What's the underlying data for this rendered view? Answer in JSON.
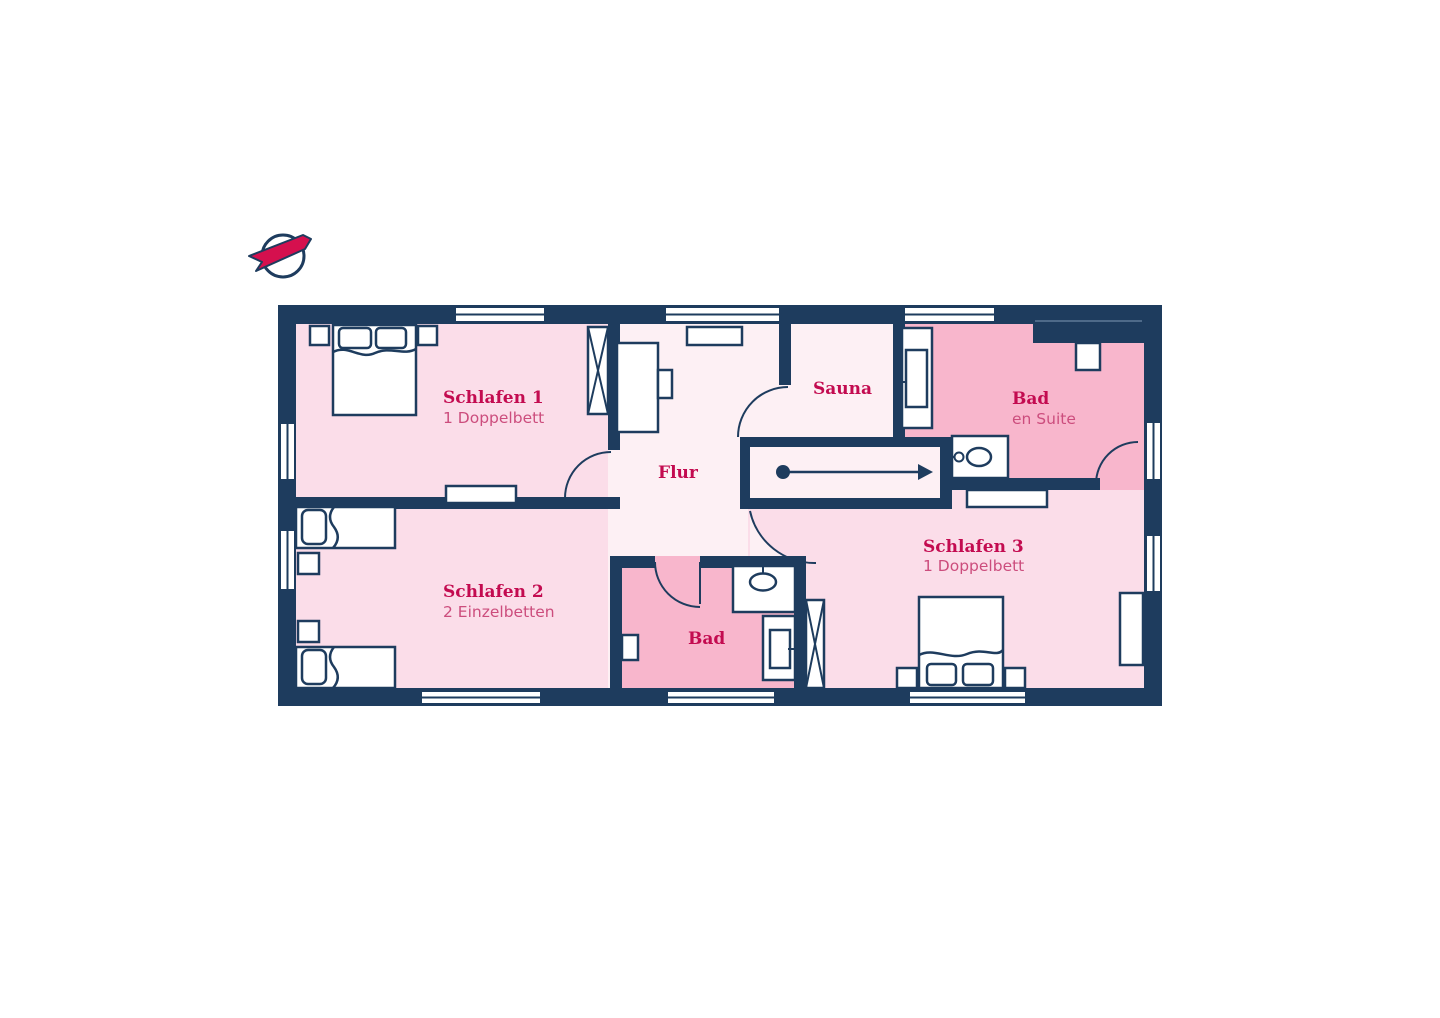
{
  "plan": {
    "type": "floor-plan",
    "compass": "north-indicator",
    "stairs_direction": "up-right"
  },
  "colors": {
    "wall": "#1e3c5e",
    "floor_hallway": "#fdf0f4",
    "floor_bedroom": "#fbdde9",
    "floor_bathroom": "#f8b6cc",
    "label_title": "#c30b50",
    "label_subtitle": "#cc4d7d",
    "compass_red": "#d5104e",
    "white": "#ffffff"
  },
  "rooms": [
    {
      "key": "schlafen1",
      "label": "Schlafen 1",
      "sublabel": "1 Doppelbett"
    },
    {
      "key": "schlafen2",
      "label": "Schlafen 2",
      "sublabel": "2 Einzelbetten"
    },
    {
      "key": "schlafen3",
      "label": "Schlafen 3",
      "sublabel": "1 Doppelbett"
    },
    {
      "key": "flur",
      "label": "Flur"
    },
    {
      "key": "sauna",
      "label": "Sauna"
    },
    {
      "key": "bad",
      "label": "Bad"
    },
    {
      "key": "bad_en_suite",
      "label": "Bad",
      "sublabel": "en Suite"
    }
  ]
}
